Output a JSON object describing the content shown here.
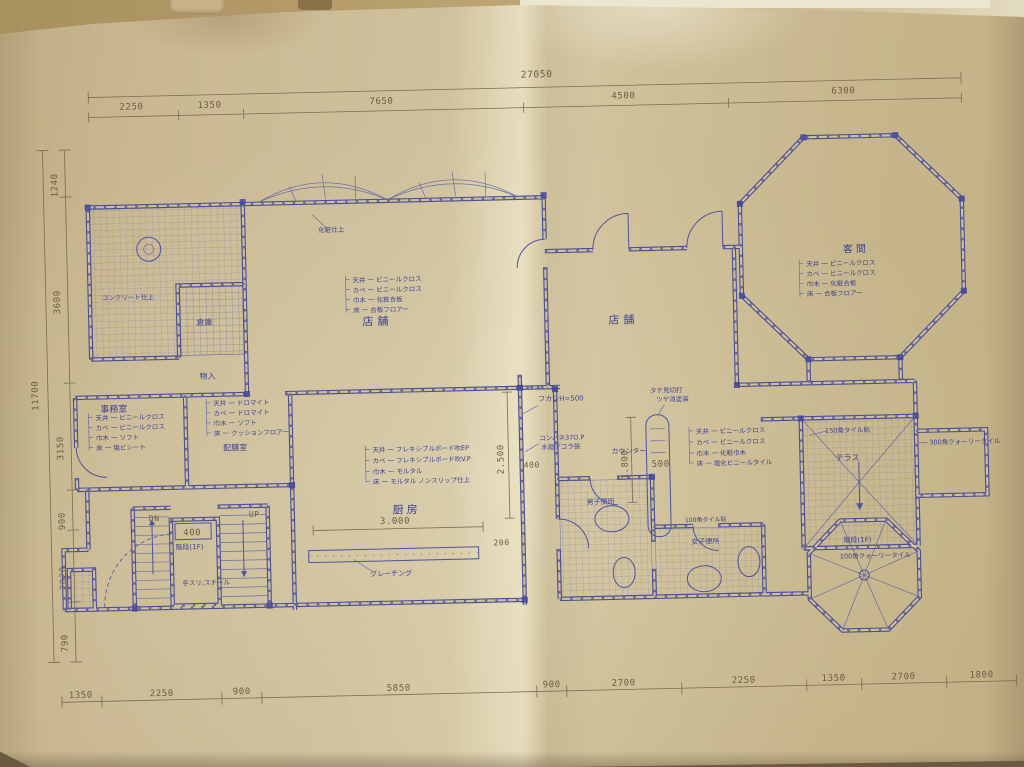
{
  "dimensions": {
    "top": {
      "total": "27050",
      "segments": [
        "2250",
        "1350",
        "7650",
        "4500",
        "6300"
      ]
    },
    "left": {
      "total": "11700",
      "segments": [
        "1240",
        "3600",
        "3150",
        "900",
        "2020",
        "790"
      ]
    },
    "bottom": {
      "segments": [
        "1350",
        "2250",
        "900",
        "5850",
        "900",
        "2700",
        "2250",
        "1350",
        "2700",
        "1800"
      ]
    },
    "interior": {
      "kitchen_width": "3.000",
      "kitchen_depth": "2.500",
      "counter_len": "1.800",
      "wall_400": "400",
      "stair_core": "400",
      "counter_500": "500",
      "step_200": "200"
    }
  },
  "rooms": {
    "shop_left": "店舗",
    "shop_center": "店舗",
    "guest": "客間",
    "office": "事務室",
    "pantry": "配膳室",
    "kitchen": "厨房",
    "storage": "物入",
    "closet": "倉庫",
    "terrace": "テラス",
    "stair_left": "階段(1F)",
    "stair_right": "階段(1F)",
    "toilet_men": "男子便所",
    "toilet_women": "女子便所"
  },
  "stairs": {
    "down": "DN",
    "up": "UP",
    "handrail": "手スリ:スチール"
  },
  "notes": {
    "fukashi": "フカシH=500",
    "konpane": "コンパネ37O.P",
    "decora": "水廻デコラ張",
    "mikiri": "タテ見切打",
    "tosou": "ツヤ消塗装",
    "counter": "カウンター",
    "grating": "グレーチング",
    "concrete": "コンクリート仕上",
    "keshou": "化粧仕上",
    "tile150": "150角タイル貼",
    "tile300": "300角クォーリータイル",
    "tile100": "100角クォーリータイル",
    "tile100b": "100角タイル貼"
  },
  "finish_schedules": {
    "shop": [
      "天井 一 ビニールクロス",
      "カベ 一 ビニールクロス",
      "巾木 一 化粧合板",
      "床  一 合板フロアー"
    ],
    "guest": [
      "天井 一 ビニールクロス",
      "カベ 一 ビニールクロス",
      "巾木 一 化粧合板",
      "床  一 合板フロアー"
    ],
    "office": [
      "天井 一 ビニールクロス",
      "カベ 一 ビニールクロス",
      "巾木 一 ソフト",
      "床  一 塩ビシート"
    ],
    "pantry": [
      "天井 一 ドロマイト",
      "カベ 一 ドロマイト",
      "巾木 一 ソフト",
      "床  一 クッションフロアー"
    ],
    "kitchen": [
      "天井 一 フレキシブルボード吹EP",
      "カベ 一 フレキシブルボード吹V.P",
      "巾木 一 モルタル",
      "床  一 モルタル ノンスリップ仕上"
    ],
    "lounge": [
      "天井 一 ビニールクロス",
      "カベ 一 ビニールクロス",
      "巾木 一 化粧巾木",
      "床  一 塩化ビニールタイル"
    ]
  }
}
